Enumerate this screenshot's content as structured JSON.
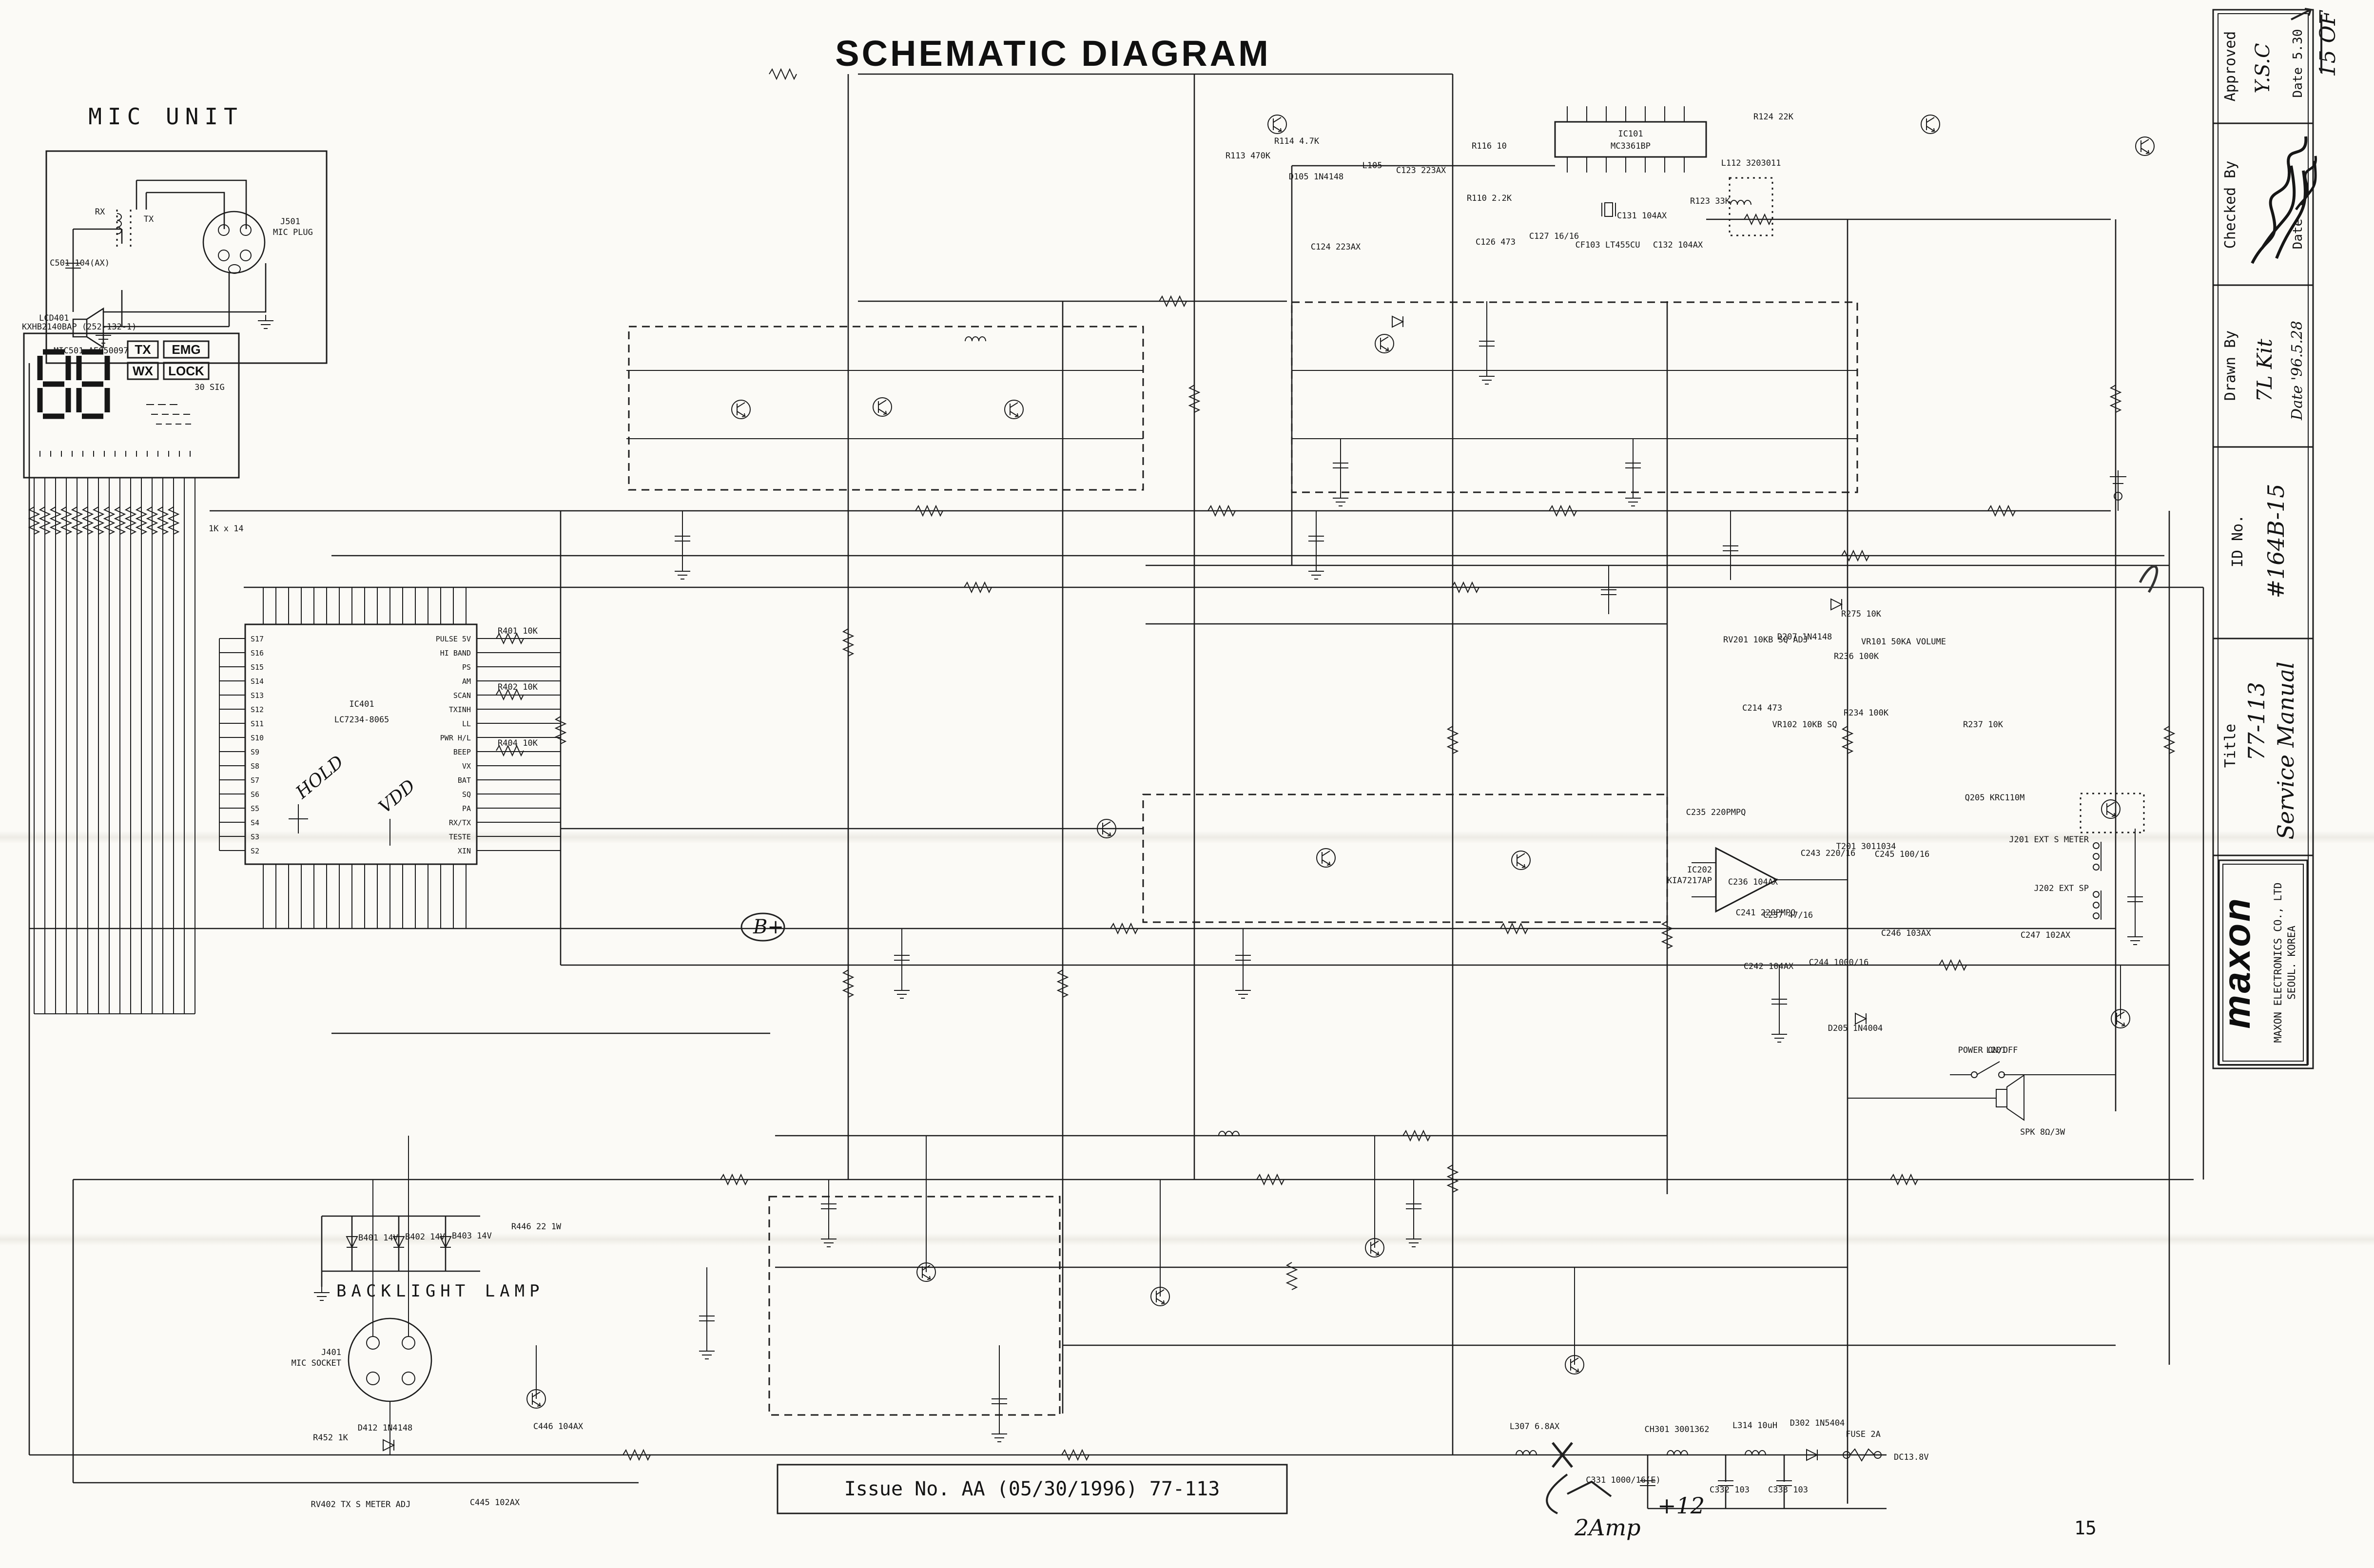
{
  "page": {
    "title": "SCHEMATIC DIAGRAM",
    "issue_label": "Issue No. AA (05/30/1996) 77-113",
    "page_number": "15",
    "sheet_note": "15 OF"
  },
  "handwritten": {
    "hold": "HOLD",
    "vdd": "VDD",
    "b_plus": "B+",
    "amps": "2Amp",
    "plus12": "+12"
  },
  "mic_unit": {
    "title": "MIC UNIT",
    "plug_ref": "J501",
    "plug_label": "MIC PLUG",
    "cap": "C501 104(AX)",
    "mic": "MIC501 AE050097",
    "rx": "RX",
    "tx": "TX"
  },
  "lcd": {
    "ref": "LCD401",
    "part": "KXHB2140BAP (252-132-1)",
    "badge_tx": "TX",
    "badge_emg": "EMG",
    "badge_wx": "WX",
    "badge_lock": "LOCK",
    "sig": "30 SIG",
    "res_bank": "1K x 14"
  },
  "cpu": {
    "ref": "IC401",
    "part": "LC7234-8065",
    "left_pins": [
      "S17",
      "S16",
      "S15",
      "S14",
      "S13",
      "S12",
      "S11",
      "S10",
      "S9",
      "S8",
      "S7",
      "S6",
      "S5",
      "S4",
      "S3",
      "S2"
    ],
    "right_pins": [
      "PULSE 5V",
      "HI BAND",
      "PS",
      "AM",
      "SCAN",
      "TXINH",
      "LL",
      "PWR H/L",
      "BEEP",
      "VX",
      "BAT",
      "SQ",
      "PA",
      "RX/TX",
      "TESTE",
      "XIN"
    ]
  },
  "ic101": {
    "ref": "IC101",
    "part": "MC3361BP"
  },
  "ic202": {
    "ref": "IC202",
    "part": "KIA7217AP"
  },
  "backlight": {
    "label": "BACKLIGHT LAMP",
    "lamp1": "B401 14V",
    "lamp2": "B402 14V",
    "lamp3": "B403 14V",
    "socket_ref": "J401",
    "socket_label": "MIC SOCKET"
  },
  "parts": {
    "r113": "R113 470K",
    "r114": "R114 4.7K",
    "d105": "D105 1N4148",
    "l105": "L105",
    "c123": "C123 223AX",
    "c124": "C124 223AX",
    "r116": "R116 10",
    "r110": "R110 2.2K",
    "c126": "C126 473",
    "c127": "C127 16/16",
    "cf103": "CF103 LT455CU",
    "c131": "C131 104AX",
    "c132": "C132 104AX",
    "l112": "L112 3203011",
    "r123": "R123 33K",
    "r124": "R124 22K",
    "rv201": "RV201 10KB SQ ADJ",
    "c214": "C214 473",
    "d207": "D207 1N4148",
    "r275": "R275 10K",
    "r236": "R236 100K",
    "r234": "R234 100K",
    "vr101": "VR101 50KA VOLUME",
    "vr102": "VR102 10KB SQ",
    "r237": "R237 10K",
    "q205": "Q205 KRC110M",
    "c236": "C236 104AX",
    "c237": "C237 47/16",
    "c235": "C235 220PMPQ",
    "c241": "C241 220PMPQ",
    "c242": "C242 104AX",
    "c243": "C243 220/16",
    "t201": "T201 3011034",
    "c245": "C245 100/16",
    "c244": "C244 1000/16",
    "c246": "C246 103AX",
    "c247": "C247 102AX",
    "d205": "D205 1N4004",
    "l201": "L201",
    "r401": "R401 10K",
    "r402": "R402 10K",
    "r404": "R404 10K",
    "r446": "R446 22 1W",
    "c446": "C446 104AX",
    "c445": "C445 102AX",
    "rv402": "RV402 TX S METER ADJ",
    "r452": "R452 1K",
    "d412": "D412 1N4148",
    "j201": "J201 EXT S METER",
    "j202": "J202 EXT SP",
    "spk": "SPK 8Ω/3W",
    "power_sw": "POWER ON/OFF",
    "dc": "DC13.8V",
    "ch301": "CH301 3001362",
    "l314": "L314 10uH",
    "d302": "D302 1N5404",
    "fuse": "FUSE 2A",
    "c331": "C331 1000/16(E)",
    "c332": "C332 103",
    "c333": "C333 103",
    "l307": "L307 6.8AX"
  },
  "title_block": {
    "approved": {
      "label": "Approved",
      "by": "Y.S.C",
      "date": "Date 5.30"
    },
    "checked": {
      "label": "Checked By",
      "date": "Date"
    },
    "drawn": {
      "label": "Drawn By",
      "by": "7L Kit",
      "date": "Date '96.5.28"
    },
    "id": {
      "label": "ID No.",
      "value": "#164B-15"
    },
    "doc_title": {
      "label": "Title",
      "line1": "77-113",
      "line2": "Service Manual"
    },
    "company": {
      "logo": "maxon",
      "name": "MAXON ELECTRONICS CO., LTD",
      "city": "SEOUL. KOREA"
    }
  }
}
